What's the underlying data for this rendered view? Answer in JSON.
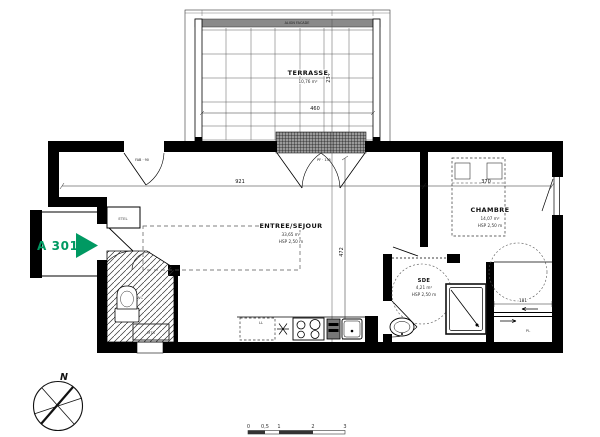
{
  "meta": {
    "unit_label": "A 301",
    "accent_color": "#009962"
  },
  "rooms": {
    "terrasse": {
      "name": "TERRASSE",
      "area": "10,76 m²"
    },
    "sejour": {
      "name": "ENTREE/SEJOUR",
      "area": "33,65 m²",
      "hsp": "HSP 2,50 m"
    },
    "chambre": {
      "name": "CHAMBRE",
      "area": "14,07 m²",
      "hsp": "HSP 2,50 m"
    },
    "sde": {
      "name": "SDE",
      "area": "4,21 m²",
      "hsp": "HSP 2,50 m"
    },
    "etel": {
      "name": "ETEL"
    },
    "wc": {
      "name": "WC"
    },
    "mta": {
      "name": "MTA"
    },
    "pl": {
      "name": "PL"
    },
    "ll": {
      "name": "LL"
    }
  },
  "dims": {
    "sejour_w": "921",
    "sejour_h": "472",
    "terrasse_w": "460",
    "terrasse_d": "234",
    "chambre_w": "370",
    "pl_w": "181"
  },
  "openings": {
    "entry_door": "FAB · 90",
    "terrace_door": "PF · 135",
    "wall_note": "ALIGN FACADE"
  },
  "compass": {
    "north": "N"
  },
  "scale": {
    "ticks": [
      "0",
      "0,5",
      "1",
      "2",
      "3"
    ]
  }
}
